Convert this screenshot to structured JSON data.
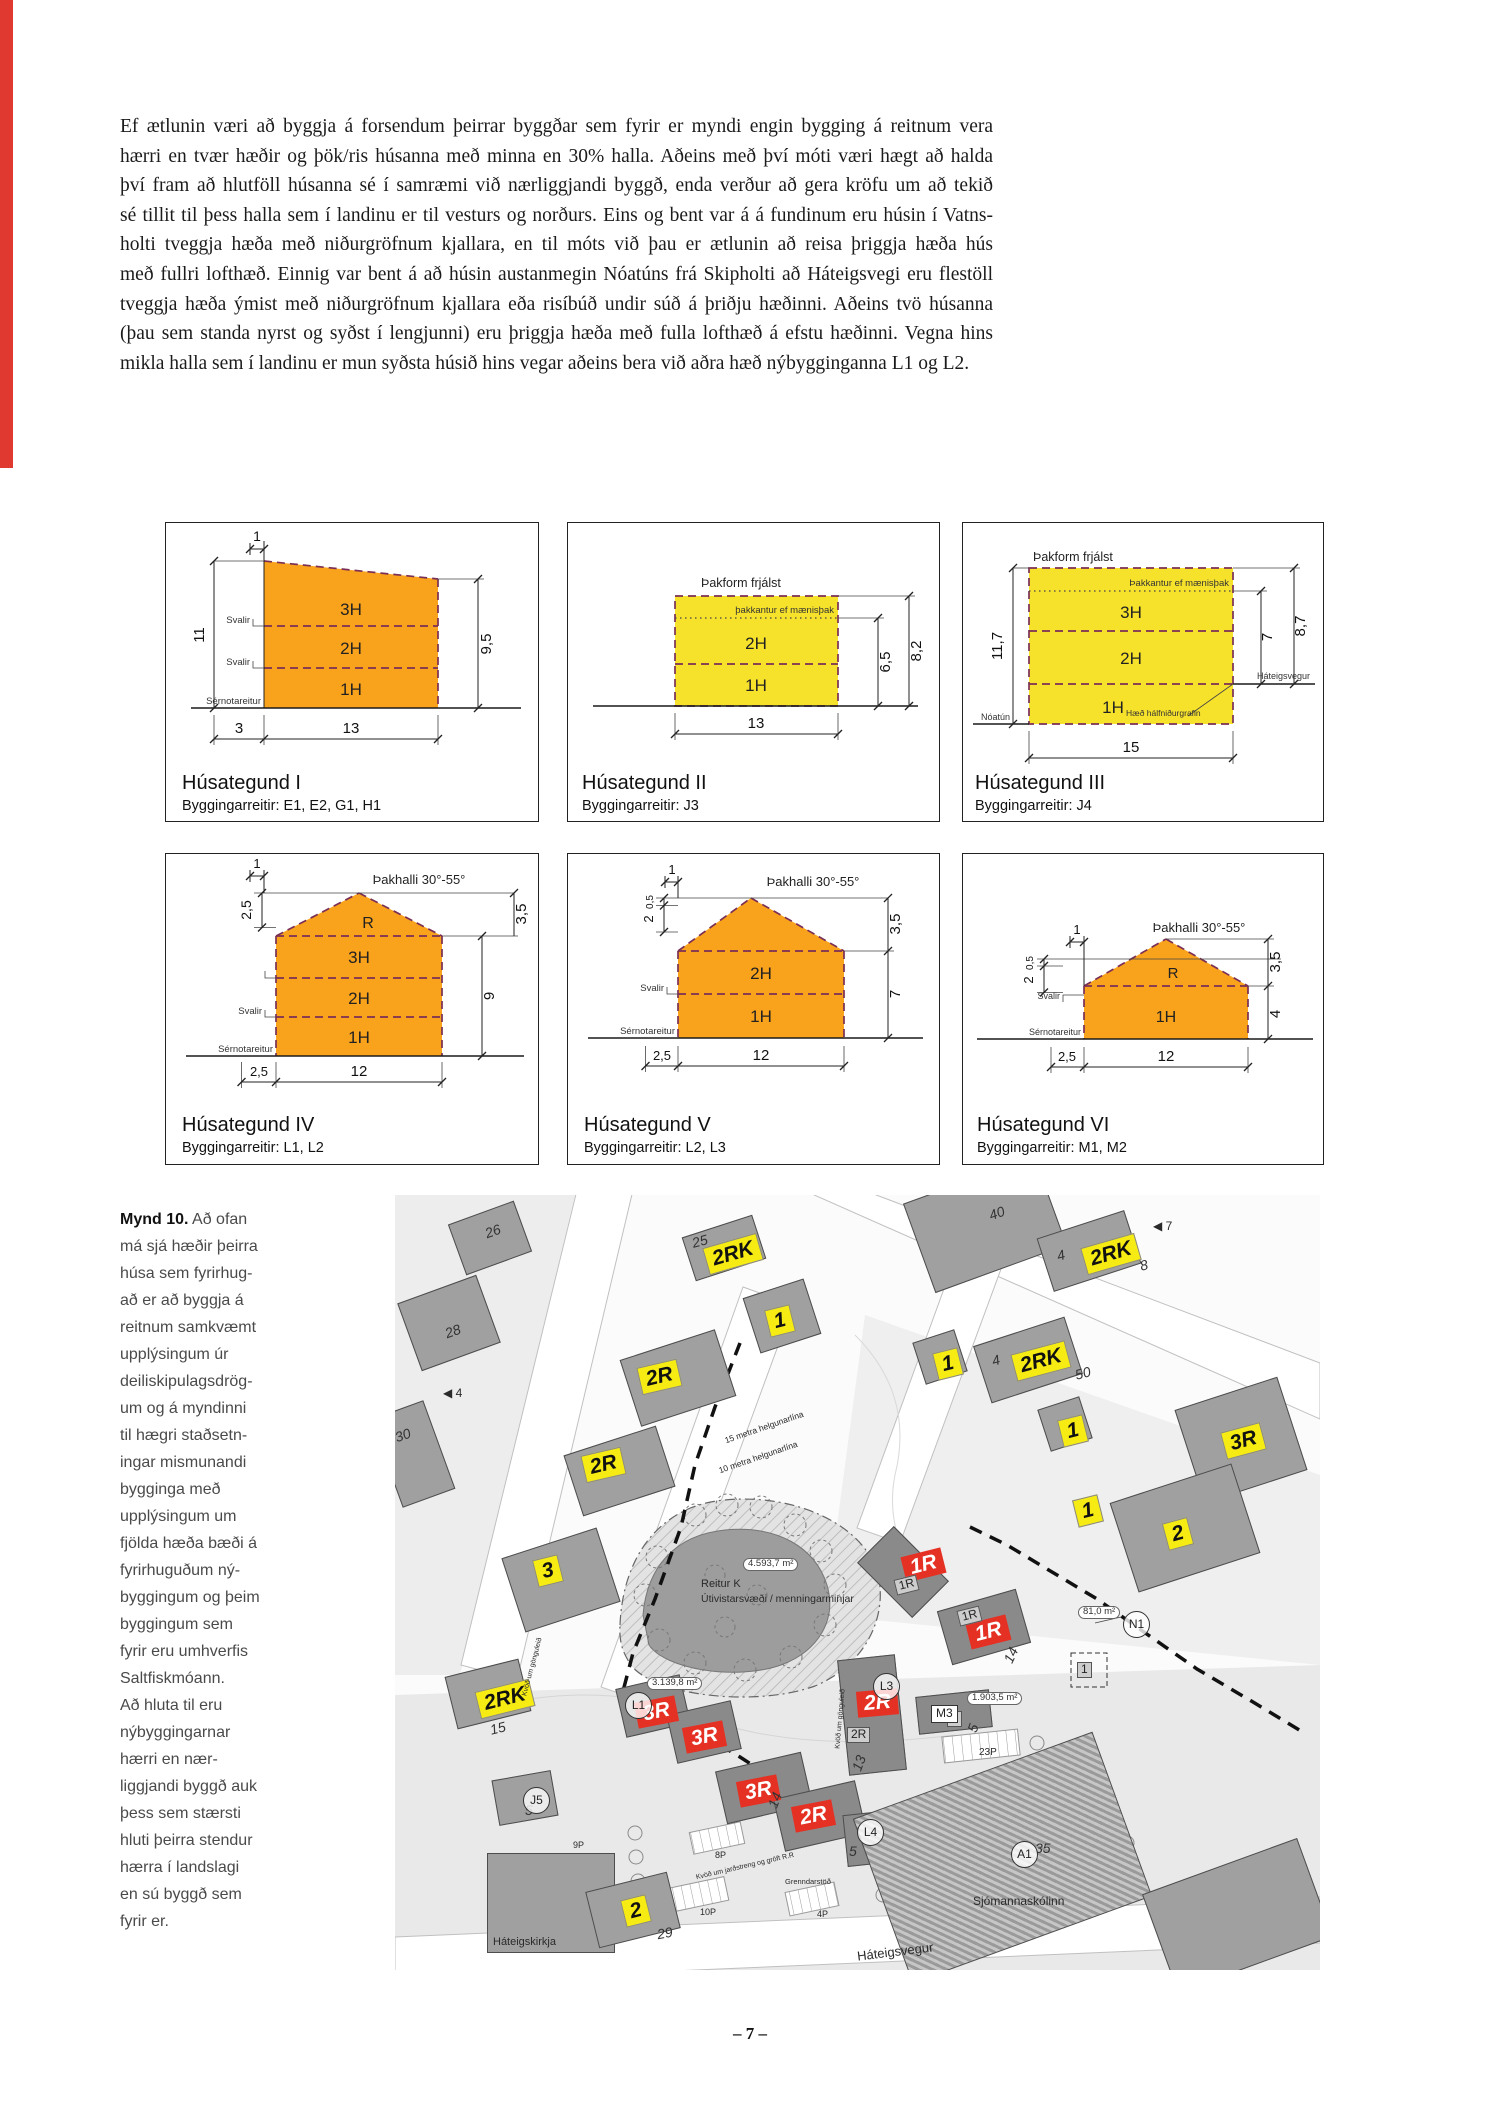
{
  "page": {
    "number": "– 7 –"
  },
  "colors": {
    "accent_red_bar": "#e0392f",
    "diagram_orange": "#F9A21B",
    "diagram_yellow": "#F7E22B",
    "diagram_dash": "#7b2f55",
    "map_tag_yellow": "#f6ec13",
    "map_tag_red": "#e53024"
  },
  "intro_paragraph": {
    "lines": [
      "Ef ætlunin væri að byggja á forsendum þeirrar byggðar sem fyrir er myndi engin bygging á reitnum vera",
      "hærri en tvær hæðir og þök/ris húsanna með minna en 30% halla. Aðeins með því móti væri hægt að halda",
      "því fram að hlutföll húsanna sé í samræmi við nærliggjandi byggð, enda verður að gera kröfu um að tekið",
      "sé tillit til þess halla sem í landinu er til vesturs og norðurs. Eins og bent var á á fundinum eru húsin í Vatns-",
      "holti tveggja hæða með niðurgröfnum kjallara, en til móts við þau er ætlunin að reisa þriggja hæða hús",
      "með fullri lofthæð. Einnig var bent á að húsin austanmegin Nóatúns frá Skipholti að Háteigsvegi eru flestöll",
      "tveggja hæða ýmist með niðurgröfnum kjallara eða risíbúð undir súð á þriðju hæðinni. Aðeins tvö húsanna",
      "(þau sem standa nyrst og syðst í lengjunni) eru þriggja hæða með fulla lofthæð á efstu hæðinni. Vegna hins",
      "mikla halla sem í landinu er mun syðsta húsið hins vegar aðeins bera við aðra hæð nýbygginganna L1 og L2."
    ]
  },
  "diagrams": [
    {
      "title": "Húsategund I",
      "subtitle": "Byggingarreitir: E1, E2, G1, H1",
      "levels": [
        "3H",
        "2H",
        "1H"
      ],
      "svalir": "Svalir",
      "sernotareitur": "Sérnotareitur",
      "dim_top": "1",
      "dim_left": "11",
      "dim_right": "9,5",
      "dim_bottom_offset": "3",
      "dim_bottom": "13"
    },
    {
      "title": "Húsategund II",
      "subtitle": "Byggingarreitir: J3",
      "roof_note": "Þakform frjálst",
      "ridge_note": "þakkantur ef mænisþak",
      "levels": [
        "2H",
        "1H"
      ],
      "dim_right_inner": "6,5",
      "dim_right_outer": "8,2",
      "dim_bottom": "13"
    },
    {
      "title": "Húsategund III",
      "subtitle": "Byggingarreitir: J4",
      "roof_note": "Þakform frjálst",
      "ridge_note": "Þakkantur ef mænisþak",
      "levels": [
        "3H",
        "2H",
        "1H"
      ],
      "half_buried_note": "Hæð hálfniðurgrafin",
      "street_left": "Nóatún",
      "street_right": "Háteigsvegur",
      "dim_left": "11,7",
      "dim_right_inner": "7",
      "dim_right_outer": "8,7",
      "dim_bottom": "15"
    },
    {
      "title": "Húsategund IV",
      "subtitle": "Byggingarreitir: L1, L2",
      "roof_note": "Þakhalli 30°-55°",
      "roof_label": "R",
      "levels": [
        "3H",
        "2H",
        "1H"
      ],
      "svalir": "Svalir",
      "sernotareitur": "Sérnotareitur",
      "dim_top": "1",
      "dim_upper_left": "2,5",
      "dim_right_roof": "3,5",
      "dim_right": "9",
      "dim_bottom_offset": "2,5",
      "dim_bottom": "12"
    },
    {
      "title": "Húsategund V",
      "subtitle": "Byggingarreitir: L2, L3",
      "roof_note": "Þakhalli 30°-55°",
      "levels": [
        "2H",
        "1H"
      ],
      "svalir": "Svalir",
      "sernotareitur": "Sérnotareitur",
      "dim_top": "1",
      "dim_left_upper": "0,5",
      "dim_left": "2",
      "dim_right_roof": "3,5",
      "dim_right": "7",
      "dim_bottom_offset": "2,5",
      "dim_bottom": "12"
    },
    {
      "title": "Húsategund VI",
      "subtitle": "Byggingarreitir: M1, M2",
      "roof_note": "Þakhalli 30°-55°",
      "roof_label": "R",
      "levels": [
        "1H"
      ],
      "svalir": "Svalir",
      "sernotareitur": "Sérnotareitur",
      "dim_top": "1",
      "dim_left_upper": "0,5",
      "dim_left": "2",
      "dim_right_roof": "3,5",
      "dim_right": "4",
      "dim_bottom_offset": "2,5",
      "dim_bottom": "12"
    }
  ],
  "figure_caption": {
    "label": "Mynd 10.",
    "lines": [
      "Að ofan",
      "má sjá hæðir þeirra",
      "húsa sem fyrirhug-",
      "að er að byggja á",
      "reitnum samkvæmt",
      "upplýsingum úr",
      "deiliskipulagsdrög-",
      "um og á myndinni",
      "til hægri staðsetn-",
      "ingar mismunandi",
      "bygginga með",
      "upplýsingum um",
      "fjölda hæða bæði á",
      "fyrirhuguðum ný-",
      "byggingum og þeim",
      "byggingum sem",
      "fyrir eru umhverfis",
      "Saltfiskmóann.",
      "Að hluta til eru",
      "nýbyggingarnar",
      "hærri en nær-",
      "liggjandi byggð auk",
      "þess sem stærsti",
      "hluti þeirra stendur",
      "hærra í landslagi",
      "en sú byggð sem",
      "fyrir er."
    ]
  },
  "map": {
    "buildings": [
      {
        "x": 60,
        "y": 16,
        "w": 70,
        "h": 54,
        "rot": -20,
        "cls": "e"
      },
      {
        "x": 12,
        "y": 92,
        "w": 84,
        "h": 72,
        "rot": -20,
        "cls": "e"
      },
      {
        "x": -10,
        "y": 212,
        "w": 56,
        "h": 94,
        "rot": -20,
        "cls": "e"
      },
      {
        "x": 292,
        "y": 30,
        "w": 74,
        "h": 46,
        "rot": -18,
        "cls": "e"
      },
      {
        "x": 355,
        "y": 92,
        "w": 64,
        "h": 58,
        "rot": -18,
        "cls": "e"
      },
      {
        "x": 233,
        "y": 148,
        "w": 100,
        "h": 70,
        "rot": -18,
        "cls": "e"
      },
      {
        "x": 176,
        "y": 244,
        "w": 97,
        "h": 64,
        "rot": -18,
        "cls": "e"
      },
      {
        "x": 116,
        "y": 346,
        "w": 100,
        "h": 78,
        "rot": -18,
        "cls": "e"
      },
      {
        "x": 520,
        "y": -18,
        "w": 140,
        "h": 95,
        "rot": -20,
        "cls": "e"
      },
      {
        "x": 648,
        "y": 28,
        "w": 92,
        "h": 56,
        "rot": -18,
        "cls": "e"
      },
      {
        "x": 585,
        "y": 135,
        "w": 96,
        "h": 60,
        "rot": -18,
        "cls": "e"
      },
      {
        "x": 523,
        "y": 140,
        "w": 44,
        "h": 44,
        "rot": -18,
        "cls": "e"
      },
      {
        "x": 792,
        "y": 196,
        "w": 108,
        "h": 98,
        "rot": -18,
        "cls": "e"
      },
      {
        "x": 726,
        "y": 286,
        "w": 128,
        "h": 94,
        "rot": -18,
        "cls": "e"
      },
      {
        "x": 648,
        "y": 207,
        "w": 44,
        "h": 44,
        "rot": -18,
        "cls": "e"
      },
      {
        "x": 55,
        "y": 472,
        "w": 76,
        "h": 54,
        "rot": -14,
        "cls": "e"
      },
      {
        "x": 92,
        "y": 658,
        "w": 128,
        "h": 100,
        "rot": 0,
        "cls": "e"
      },
      {
        "x": 196,
        "y": 686,
        "w": 84,
        "h": 58,
        "rot": -14,
        "cls": "e"
      },
      {
        "x": 100,
        "y": 580,
        "w": 60,
        "h": 46,
        "rot": -10,
        "cls": "e"
      },
      {
        "x": 482,
        "y": 338,
        "w": 52,
        "h": 78,
        "rot": -45,
        "cls": "n"
      },
      {
        "x": 548,
        "y": 404,
        "w": 82,
        "h": 56,
        "rot": -16,
        "cls": "n"
      },
      {
        "x": 448,
        "y": 462,
        "w": 58,
        "h": 116,
        "rot": -6,
        "cls": "n"
      },
      {
        "x": 225,
        "y": 486,
        "w": 66,
        "h": 50,
        "rot": -13,
        "cls": "n"
      },
      {
        "x": 276,
        "y": 512,
        "w": 66,
        "h": 50,
        "rot": -13,
        "cls": "n"
      },
      {
        "x": 325,
        "y": 566,
        "w": 88,
        "h": 54,
        "rot": -13,
        "cls": "n"
      },
      {
        "x": 383,
        "y": 594,
        "w": 84,
        "h": 54,
        "rot": -13,
        "cls": "n"
      },
      {
        "x": 450,
        "y": 618,
        "w": 40,
        "h": 52,
        "rot": -6,
        "cls": "n"
      },
      {
        "x": 522,
        "y": 498,
        "w": 74,
        "h": 38,
        "rot": -6,
        "cls": "n"
      },
      {
        "x": 480,
        "y": 575,
        "w": 255,
        "h": 175,
        "rot": -20,
        "cls": "h"
      },
      {
        "x": 760,
        "y": 668,
        "w": 165,
        "h": 105,
        "rot": -20,
        "cls": "e"
      }
    ],
    "labels": [
      {
        "t": "2RK",
        "x": 310,
        "y": 45,
        "r": -16,
        "k": "y"
      },
      {
        "t": "1",
        "x": 372,
        "y": 112,
        "r": -14,
        "k": "y"
      },
      {
        "t": "2R",
        "x": 244,
        "y": 168,
        "r": -13,
        "k": "y"
      },
      {
        "t": "2R",
        "x": 188,
        "y": 256,
        "r": -13,
        "k": "y"
      },
      {
        "t": "3",
        "x": 140,
        "y": 362,
        "r": -14,
        "k": "y"
      },
      {
        "t": "2RK",
        "x": 688,
        "y": 45,
        "r": -16,
        "k": "y"
      },
      {
        "t": "2RK",
        "x": 618,
        "y": 152,
        "r": -15,
        "k": "y"
      },
      {
        "t": "1",
        "x": 540,
        "y": 155,
        "r": -14,
        "k": "y"
      },
      {
        "t": "3R",
        "x": 828,
        "y": 232,
        "r": -15,
        "k": "y"
      },
      {
        "t": "1",
        "x": 665,
        "y": 222,
        "r": -14,
        "k": "y"
      },
      {
        "t": "1",
        "x": 680,
        "y": 302,
        "r": -14,
        "k": "y"
      },
      {
        "t": "2",
        "x": 770,
        "y": 325,
        "r": -15,
        "k": "y"
      },
      {
        "t": "2RK",
        "x": 82,
        "y": 490,
        "r": -14,
        "k": "y"
      },
      {
        "t": "2",
        "x": 228,
        "y": 702,
        "r": -14,
        "k": "y"
      },
      {
        "t": "1R",
        "x": 508,
        "y": 357,
        "r": -14,
        "k": "r"
      },
      {
        "t": "1R",
        "x": 573,
        "y": 424,
        "r": -14,
        "k": "r"
      },
      {
        "t": "2R",
        "x": 462,
        "y": 495,
        "r": -5,
        "k": "r"
      },
      {
        "t": "3R",
        "x": 241,
        "y": 504,
        "r": -11,
        "k": "r"
      },
      {
        "t": "3R",
        "x": 289,
        "y": 529,
        "r": -11,
        "k": "r"
      },
      {
        "t": "3R",
        "x": 343,
        "y": 583,
        "r": -11,
        "k": "r"
      },
      {
        "t": "2R",
        "x": 398,
        "y": 608,
        "r": -11,
        "k": "r"
      },
      {
        "t": "26",
        "x": 90,
        "y": 28,
        "r": -20,
        "k": "g"
      },
      {
        "t": "28",
        "x": 50,
        "y": 128,
        "r": -20,
        "k": "g"
      },
      {
        "t": "30",
        "x": 0,
        "y": 232,
        "r": -20,
        "k": "g"
      },
      {
        "t": "25",
        "x": 297,
        "y": 38,
        "r": -15,
        "k": "g"
      },
      {
        "t": "40",
        "x": 594,
        "y": 10,
        "r": -20,
        "k": "g"
      },
      {
        "t": "4",
        "x": 662,
        "y": 52,
        "r": -15,
        "k": "g"
      },
      {
        "t": "8",
        "x": 745,
        "y": 62,
        "r": -15,
        "k": "g"
      },
      {
        "t": "4",
        "x": 597,
        "y": 157,
        "r": -15,
        "k": "g"
      },
      {
        "t": "50",
        "x": 680,
        "y": 170,
        "r": -15,
        "k": "g"
      },
      {
        "t": "29",
        "x": 262,
        "y": 730,
        "r": -10,
        "k": "g"
      },
      {
        "t": "15",
        "x": 95,
        "y": 525,
        "r": -14,
        "k": "g"
      },
      {
        "t": "14",
        "x": 608,
        "y": 452,
        "r": -65,
        "k": "g"
      },
      {
        "t": "13",
        "x": 456,
        "y": 560,
        "r": -70,
        "k": "g"
      },
      {
        "t": "14",
        "x": 372,
        "y": 597,
        "r": -70,
        "k": "g"
      },
      {
        "t": "5",
        "x": 574,
        "y": 525,
        "r": -70,
        "k": "g"
      },
      {
        "t": "5",
        "x": 454,
        "y": 648,
        "r": 0,
        "k": "g"
      },
      {
        "t": "5",
        "x": 130,
        "y": 607,
        "r": 0,
        "k": "g"
      },
      {
        "t": "35",
        "x": 640,
        "y": 645,
        "r": 0,
        "k": "g"
      },
      {
        "t": "1R",
        "x": 500,
        "y": 382,
        "r": -14,
        "k": "gb"
      },
      {
        "t": "1R",
        "x": 563,
        "y": 413,
        "r": -14,
        "k": "gb"
      },
      {
        "t": "2R",
        "x": 452,
        "y": 532,
        "r": 0,
        "k": "gb"
      },
      {
        "t": "1",
        "x": 552,
        "y": 516,
        "r": 0,
        "k": "gb"
      },
      {
        "t": "1",
        "x": 682,
        "y": 467,
        "r": 0,
        "k": "gb"
      },
      {
        "t": "M3",
        "x": 536,
        "y": 510,
        "r": 0,
        "k": "bx"
      },
      {
        "t": "N1",
        "x": 728,
        "y": 416,
        "r": 0,
        "k": "c"
      },
      {
        "t": "L1",
        "x": 230,
        "y": 497,
        "r": 0,
        "k": "c"
      },
      {
        "t": "L3",
        "x": 478,
        "y": 478,
        "r": 0,
        "k": "c"
      },
      {
        "t": "L4",
        "x": 462,
        "y": 624,
        "r": 0,
        "k": "c"
      },
      {
        "t": "A1",
        "x": 616,
        "y": 646,
        "r": 0,
        "k": "c"
      },
      {
        "t": "J5",
        "x": 128,
        "y": 592,
        "r": 0,
        "k": "c"
      },
      {
        "t": "4.593,7 m²",
        "x": 348,
        "y": 363,
        "r": 0,
        "k": "badge"
      },
      {
        "t": "3.139,8 m²",
        "x": 252,
        "y": 482,
        "r": 0,
        "k": "badge"
      },
      {
        "t": "81,0 m²",
        "x": 683,
        "y": 411,
        "r": 0,
        "k": "badge"
      },
      {
        "t": "1.903,5 m²",
        "x": 572,
        "y": 497,
        "r": 0,
        "k": "badge"
      },
      {
        "t": "Reitur K",
        "x": 306,
        "y": 383,
        "r": 0,
        "k": "t",
        "s": 11
      },
      {
        "t": "Útivistarsvæði / menningarminjar",
        "x": 306,
        "y": 398,
        "r": 0,
        "k": "t",
        "s": 10.5
      },
      {
        "t": "Sjómannaskólinn",
        "x": 578,
        "y": 700,
        "r": 0,
        "k": "t",
        "s": 12
      },
      {
        "t": "Háteigskirkja",
        "x": 98,
        "y": 741,
        "r": 0,
        "k": "t",
        "s": 11
      },
      {
        "t": "Háteigsvegur",
        "x": 462,
        "y": 750,
        "r": -7,
        "k": "t",
        "s": 13
      },
      {
        "t": "15 metra helgunarlína",
        "x": 328,
        "y": 228,
        "r": -19,
        "k": "t",
        "s": 8.5
      },
      {
        "t": "10 metra helgunarlína",
        "x": 322,
        "y": 258,
        "r": -19,
        "k": "t",
        "s": 8.5
      },
      {
        "t": "23P",
        "x": 584,
        "y": 552,
        "r": 0,
        "k": "t",
        "s": 10
      },
      {
        "t": "8P",
        "x": 320,
        "y": 655,
        "r": 0,
        "k": "t",
        "s": 9
      },
      {
        "t": "9P",
        "x": 178,
        "y": 645,
        "r": 0,
        "k": "t",
        "s": 9
      },
      {
        "t": "10P",
        "x": 305,
        "y": 712,
        "r": 0,
        "k": "t",
        "s": 9
      },
      {
        "t": "4P",
        "x": 422,
        "y": 714,
        "r": 0,
        "k": "t",
        "s": 9
      },
      {
        "t": "Grenndarstöð",
        "x": 390,
        "y": 683,
        "r": 0,
        "k": "t",
        "s": 7.5
      },
      {
        "t": "◀ 4",
        "x": 48,
        "y": 192,
        "r": 0,
        "k": "t",
        "s": 12
      },
      {
        "t": "◀ 7",
        "x": 758,
        "y": 25,
        "r": 0,
        "k": "t",
        "s": 12
      },
      {
        "t": "Kvöð um jarðstreng og gröft R.R",
        "x": 300,
        "y": 668,
        "r": -13,
        "k": "t",
        "s": 7
      },
      {
        "t": "Kvöð um gönguleið",
        "x": 416,
        "y": 520,
        "r": -85,
        "k": "t",
        "s": 7
      },
      {
        "t": "Kvöð um gönguleið",
        "x": 108,
        "y": 468,
        "r": -75,
        "k": "t",
        "s": 7
      }
    ]
  }
}
